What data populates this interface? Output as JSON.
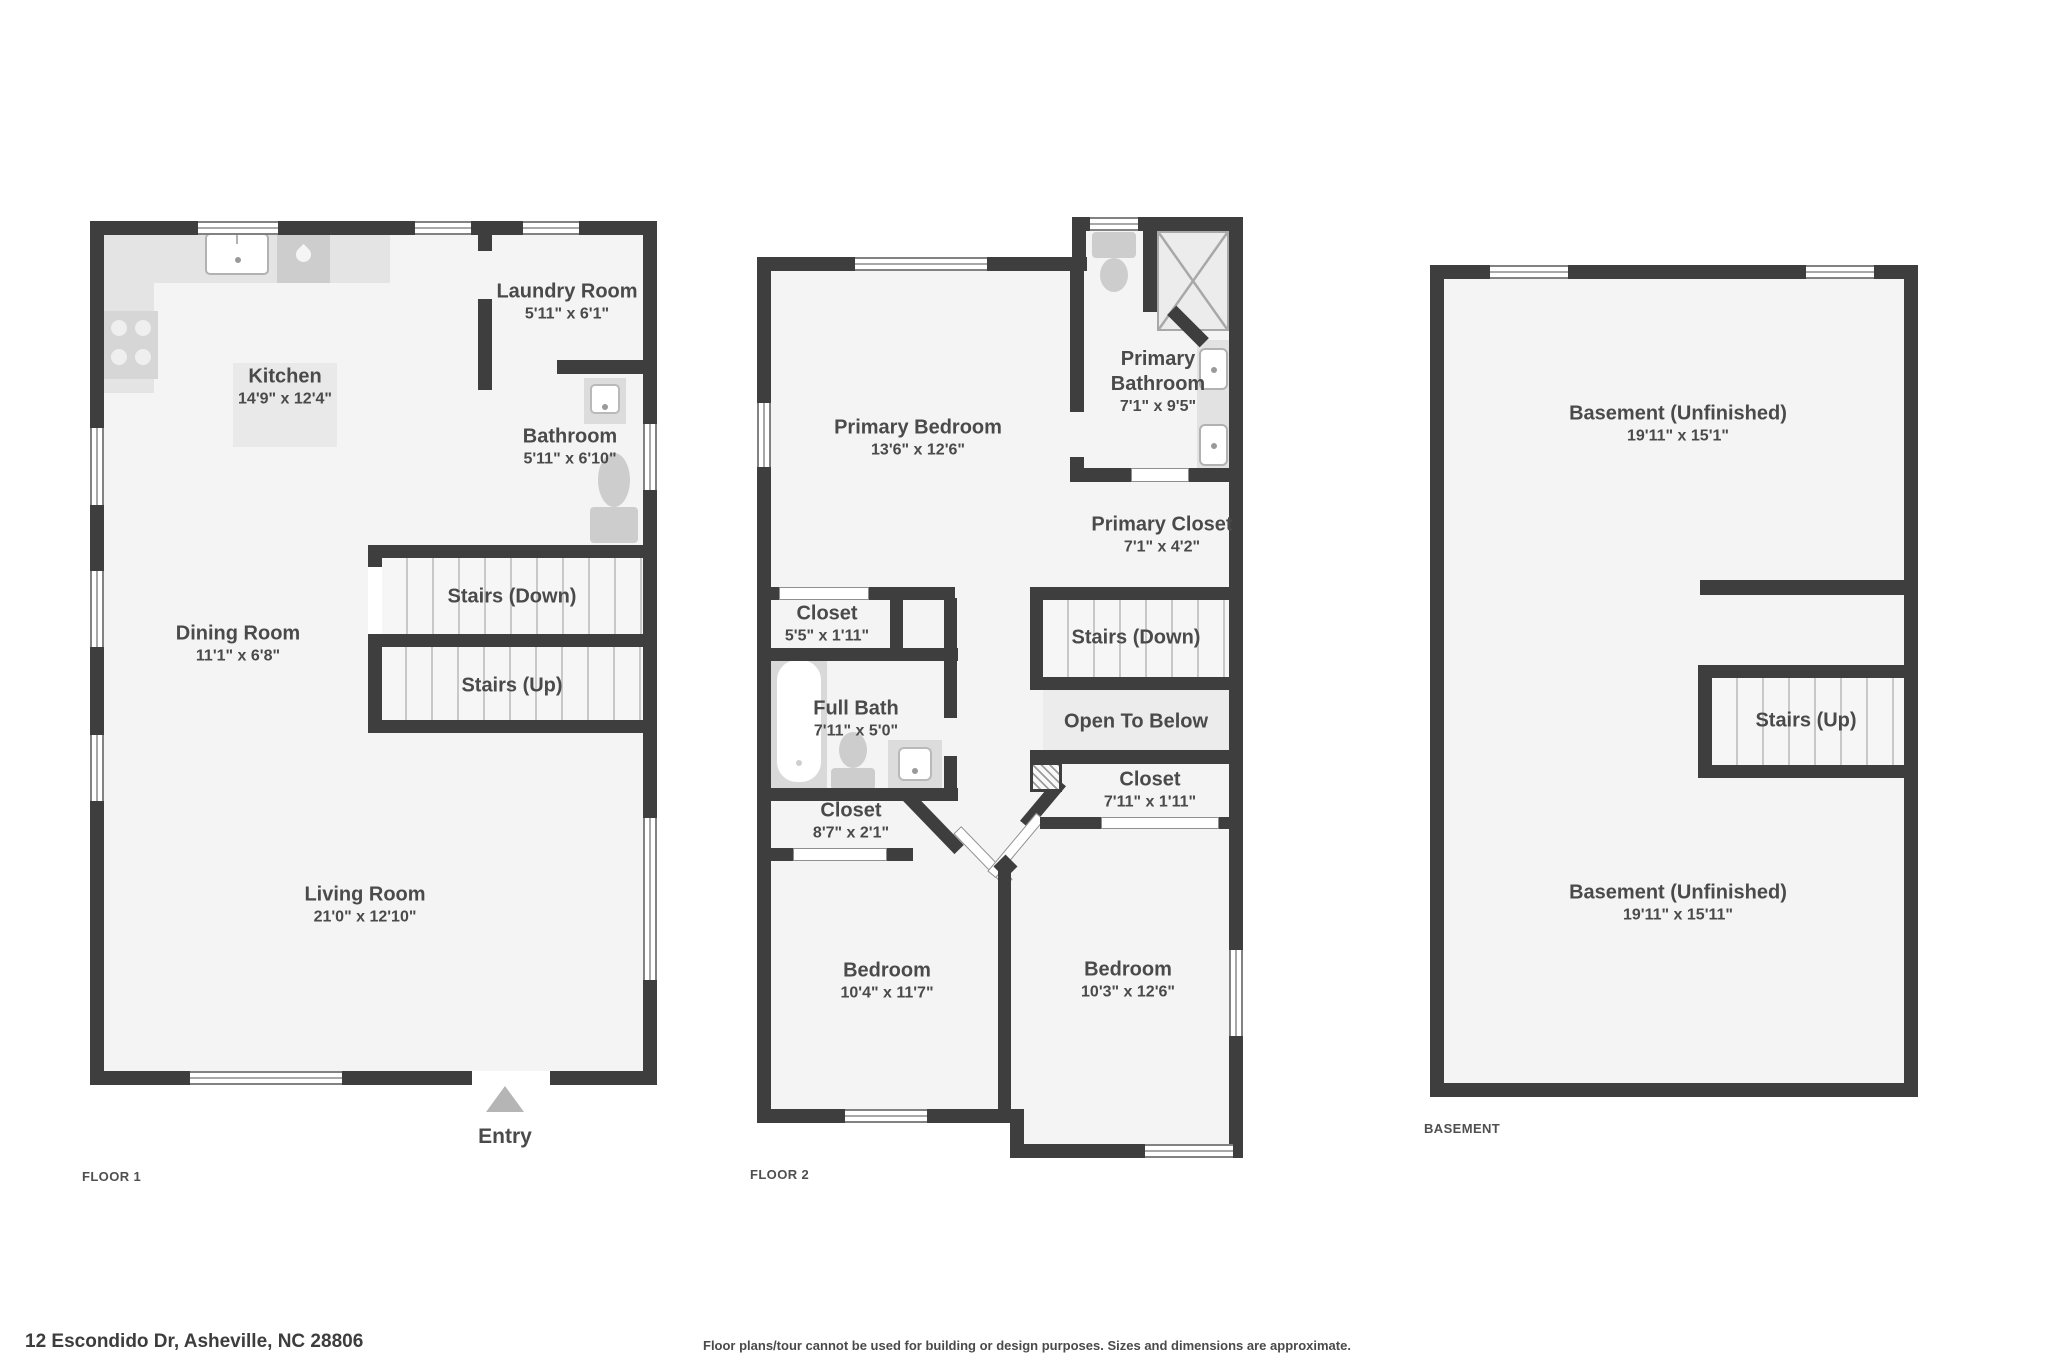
{
  "title": "Floor plan - 12 Escondido Dr",
  "colors": {
    "wall": "#3e3e3e",
    "floor": "#f4f4f4",
    "fixture": "#d9d9d9",
    "stair_line": "#c8c8c8",
    "label_text": "#4a4a4a",
    "entry_arrow": "#b5b5b5"
  },
  "floors": [
    {
      "label": "FLOOR 1",
      "rooms": [
        {
          "name": "Kitchen",
          "dims": "14'9\" x 12'4\""
        },
        {
          "name": "Laundry Room",
          "dims": "5'11\" x 6'1\""
        },
        {
          "name": "Bathroom",
          "dims": "5'11\" x 6'10\""
        },
        {
          "name": "Stairs (Down)"
        },
        {
          "name": "Stairs (Up)"
        },
        {
          "name": "Dining Room",
          "dims": "11'1\" x 6'8\""
        },
        {
          "name": "Living Room",
          "dims": "21'0\" x 12'10\""
        },
        {
          "name": "Entry"
        }
      ]
    },
    {
      "label": "FLOOR 2",
      "rooms": [
        {
          "name": "Primary Bedroom",
          "dims": "13'6\" x 12'6\""
        },
        {
          "name": "Primary Bathroom",
          "dims": "7'1\" x 9'5\""
        },
        {
          "name": "Primary Closet",
          "dims": "7'1\" x 4'2\""
        },
        {
          "name": "Closet",
          "dims": "5'5\" x 1'11\""
        },
        {
          "name": "Stairs (Down)"
        },
        {
          "name": "Full Bath",
          "dims": "7'11\" x 5'0\""
        },
        {
          "name": "Open To Below"
        },
        {
          "name": "Closet",
          "dims": "8'7\" x 2'1\""
        },
        {
          "name": "Closet",
          "dims": "7'11\" x 1'11\""
        },
        {
          "name": "Bedroom",
          "dims": "10'4\" x 11'7\""
        },
        {
          "name": "Bedroom",
          "dims": "10'3\" x 12'6\""
        }
      ]
    },
    {
      "label": "BASEMENT",
      "rooms": [
        {
          "name": "Basement (Unfinished)",
          "dims": "19'11\" x 15'1\""
        },
        {
          "name": "Stairs (Up)"
        },
        {
          "name": "Basement (Unfinished)",
          "dims": "19'11\" x 15'11\""
        }
      ]
    }
  ],
  "footer": {
    "address": "12 Escondido Dr, Asheville, NC 28806",
    "disclaimer": "Floor plans/tour cannot be used for building or design purposes. Sizes and dimensions are approximate."
  }
}
